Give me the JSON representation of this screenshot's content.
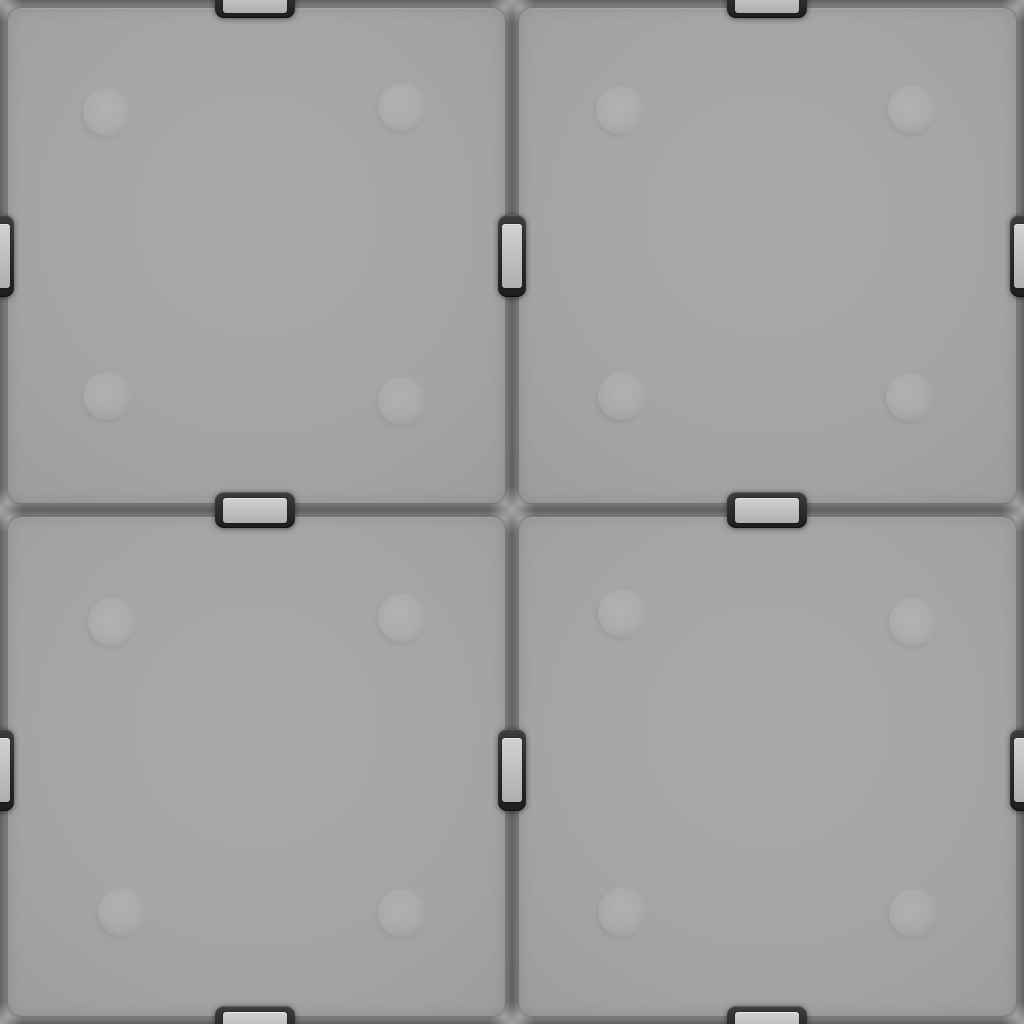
{
  "meta": {
    "type": "seamless-panel-texture",
    "width": 1024,
    "height": 1024,
    "description": "3D-rendered seamless gray armor-plate texture: four rounded square panels in a 2x2 grid separated by dark recessed seams, joined by dark rectangular fastener clips with light metal plates at the midpoint of each panel edge (clips are cut in half at the image borders so the texture tiles), and faint circular rivet bumps on each panel"
  },
  "colors": {
    "background": "#919191",
    "seam": "#646464",
    "panel_center": "#a9a9a9",
    "panel_base": "#a5a5a5",
    "panel_edge": "#9d9d9d",
    "panel_rim_shadow": "rgba(55,55,55,0.40)",
    "panel_inner_shadow": "rgba(0,0,0,0.10)",
    "panel_top_highlight": "rgba(255,255,255,0.12)",
    "clip_dark_top": "#3d3d3d",
    "clip_dark_bottom": "#1e1e1e",
    "clip_shadow": "rgba(0,0,0,0.50)",
    "clip_rim_highlight": "rgba(255,255,255,0.20)",
    "clip_plate_light": "#d1d1d1",
    "clip_plate_shade": "#afafaf",
    "rivet_light_strong": "rgba(255,255,255,0.15)",
    "rivet_light_soft": "rgba(255,255,255,0.07)",
    "rivet_shadow": "rgba(0,0,0,0.05)",
    "glow": "rgba(208,208,208,0.60)"
  },
  "layout": {
    "panel_radius": 14,
    "panels": [
      {
        "id": "panel-top-left",
        "x": 8,
        "y": 8,
        "w": 497,
        "h": 495
      },
      {
        "id": "panel-top-right",
        "x": 519,
        "y": 8,
        "w": 497,
        "h": 495
      },
      {
        "id": "panel-bottom-left",
        "x": 8,
        "y": 517,
        "w": 497,
        "h": 499
      },
      {
        "id": "panel-bottom-right",
        "x": 519,
        "y": 517,
        "w": 497,
        "h": 499
      }
    ],
    "seams": {
      "horizontal_y": [
        0,
        510,
        1024
      ],
      "vertical_x": [
        0,
        512,
        1024
      ],
      "thickness": 16
    }
  },
  "clips": {
    "horizontal": {
      "w": 80,
      "h": 36,
      "plate_w": 64,
      "plate_h": 25,
      "radius": 9,
      "plate_radius": 3
    },
    "vertical": {
      "w": 28,
      "h": 82,
      "plate_w": 20,
      "plate_h": 64,
      "radius": 9,
      "plate_radius": 3
    },
    "items": [
      {
        "x": 255,
        "y": 0,
        "orient": "horizontal"
      },
      {
        "x": 767,
        "y": 0,
        "orient": "horizontal"
      },
      {
        "x": 255,
        "y": 510,
        "orient": "horizontal"
      },
      {
        "x": 767,
        "y": 510,
        "orient": "horizontal"
      },
      {
        "x": 255,
        "y": 1024,
        "orient": "horizontal"
      },
      {
        "x": 767,
        "y": 1024,
        "orient": "horizontal"
      },
      {
        "x": 0,
        "y": 256,
        "orient": "vertical"
      },
      {
        "x": 0,
        "y": 770,
        "orient": "vertical"
      },
      {
        "x": 512,
        "y": 256,
        "orient": "vertical"
      },
      {
        "x": 512,
        "y": 770,
        "orient": "vertical"
      },
      {
        "x": 1024,
        "y": 256,
        "orient": "vertical"
      },
      {
        "x": 1024,
        "y": 770,
        "orient": "vertical"
      }
    ]
  },
  "rivets": {
    "diameter": 48,
    "items": [
      {
        "x": 107,
        "y": 112
      },
      {
        "x": 402,
        "y": 107
      },
      {
        "x": 107,
        "y": 396
      },
      {
        "x": 402,
        "y": 401
      },
      {
        "x": 620,
        "y": 110
      },
      {
        "x": 912,
        "y": 109
      },
      {
        "x": 622,
        "y": 396
      },
      {
        "x": 910,
        "y": 397
      },
      {
        "x": 112,
        "y": 622
      },
      {
        "x": 402,
        "y": 618
      },
      {
        "x": 122,
        "y": 912
      },
      {
        "x": 402,
        "y": 913
      },
      {
        "x": 622,
        "y": 613
      },
      {
        "x": 913,
        "y": 622
      },
      {
        "x": 622,
        "y": 912
      },
      {
        "x": 913,
        "y": 913
      }
    ]
  }
}
